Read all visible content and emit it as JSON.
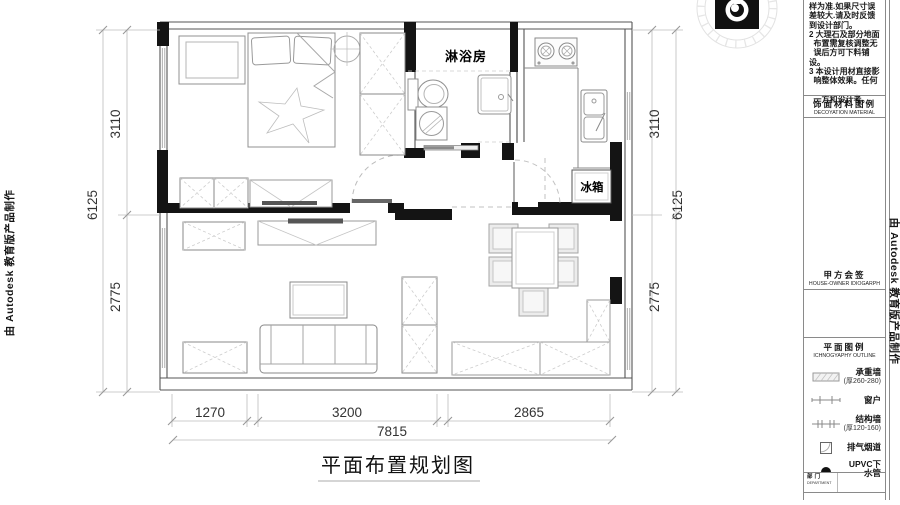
{
  "edge_watermarks": {
    "left": "由 Autodesk 教育版产品制作",
    "right": "由 Autodesk 教育版产品制作"
  },
  "plan": {
    "title": "平面布置规划图",
    "labels": {
      "shower_room": "淋浴房",
      "fridge": "冰箱"
    },
    "dimensions": {
      "left": {
        "total": "6125",
        "top": "3110",
        "bottom": "2775"
      },
      "right": {
        "total": "6125",
        "top": "3110",
        "bottom": "2775"
      },
      "bottom": {
        "seg1": "1270",
        "seg2": "3200",
        "seg3": "2865",
        "total": "7815"
      }
    }
  },
  "sidebar": {
    "notes": [
      "样为准.如果尺寸误",
      "差较大.请及时反馈",
      "到设计部门。",
      "2 大理石及部分地面",
      "  布置需复核调整无",
      "  误后方可下料铺设。",
      "3 本设计用材直接影",
      "  响整体效果。任何",
      "",
      "  一方和设计者。"
    ],
    "material_header": {
      "zh": "饰面材料图例",
      "en": "DECOYATION MATERIAL"
    },
    "owner_sign": {
      "zh": "甲方会签",
      "en": "HOUSE-OWNER IDIOGARPH"
    },
    "legend_header": {
      "zh": "平面图例",
      "en": "ICHNOGYAPHY OUTLINE"
    },
    "legend_items": [
      {
        "icon": "bearing-wall-icon",
        "label": "承重墙",
        "sub": "(厚260-280)"
      },
      {
        "icon": "window-icon",
        "label": "窗户",
        "sub": ""
      },
      {
        "icon": "structure-wall-icon",
        "label": "结构墙",
        "sub": "(厚120-160)"
      },
      {
        "icon": "exhaust-flue-icon",
        "label": "排气烟道",
        "sub": ""
      },
      {
        "icon": "upvc-pipe-icon",
        "label": "UPVC下水管",
        "sub": ""
      }
    ],
    "footer": {
      "zh": "部门",
      "en": "DEPARTMENT"
    }
  }
}
